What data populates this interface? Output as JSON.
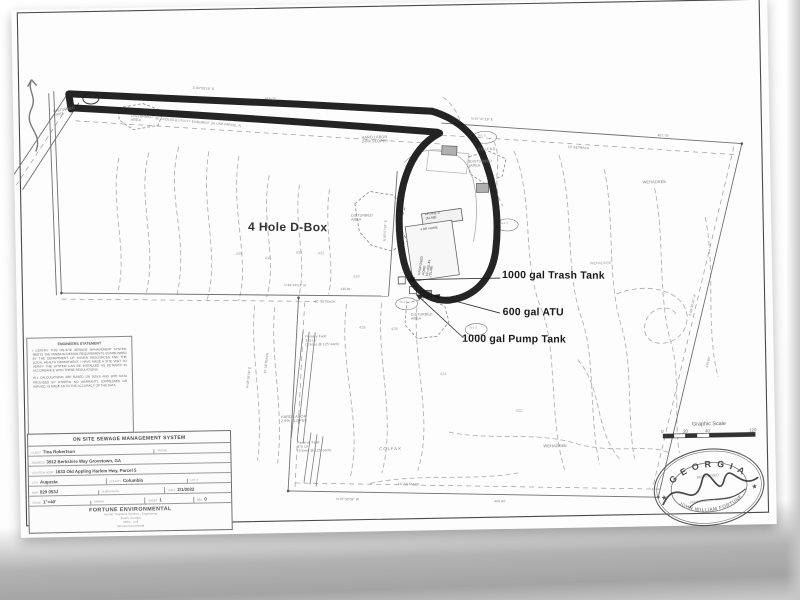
{
  "annotations": {
    "d_box": "4 Hole D-Box",
    "trash_tank": "1000 gal Trash Tank",
    "atu": "600 gal ATU",
    "pump_tank": "1000 gal Pump Tank"
  },
  "engineer_statement": {
    "title": "ENGINEERS STATEMENT",
    "para1": "I CERTIFY THIS ON-SITE SEWAGE MANAGEMENT SYSTEM MEETS THE MINIMUM DESIGN REQUIREMENTS ESTABLISHED BY THE DEPARTMENT OF HUMAN RESOURCES AND THE LOCAL HEALTH DEPARTMENT. I HAVE MADE A SITE VISIT TO VERIFY THE SYSTEM CAN BE INSTALLED AS DETAILED IN ACCORDANCE WITH THESE REGULATIONS.",
    "para2": "ALL CALCULATIONS ARE BASED ON SOILS AND SITE DATA PROVIDED BY OTHERS. NO WARRANTY, EXPRESSED OR IMPLIED, IS MADE AS TO THE ACCURACY OF THE DATA."
  },
  "title_block": {
    "header": "ON SITE SEWAGE MANAGEMENT SYSTEM",
    "client_label": "CLIENT",
    "client": "Tina Robertson",
    "phone_label": "PHONE",
    "address_label": "ADDRESS",
    "address": "3912 Berkshire Way Grovetown, GA",
    "location_label": "LOCATION ADDR",
    "location": "1633 Old Appling Harlem Hwy, Parcel 5",
    "city_label": "CITY",
    "city": "Augusta",
    "county_label": "COUNTY",
    "county": "Columbia",
    "lot_label": "LOT #",
    "map_label": "MAP",
    "map": "029 053J",
    "subdivision_label": "SUBDIVISION",
    "date_label": "DATE",
    "date": "2/1/2022",
    "scale_label": "SCALE",
    "scale": "1\"=40'",
    "drawn_label": "DRAWN",
    "sheet_label": "SHEET",
    "sheet": "1",
    "rev_label": "REV",
    "rev": "0",
    "company": "FORTUNE ENVIRONMENTAL",
    "company_lines": [
      "Aerobic Treatment Systems - Engineering",
      "Evans, Georgia",
      "Office - Cell",
      "fortuneenvironmental"
    ]
  },
  "scale_bar": {
    "title": "Graphic Scale",
    "ticks": [
      "0",
      "20",
      "40",
      "120"
    ]
  },
  "seal": {
    "state": "G E O R G I A",
    "name": "JOHN WILLIAM FORTUNE",
    "inner_top": "REGISTERED",
    "inner_mid": "PROFESSIONAL ENGINEER",
    "star": "★"
  },
  "map_labels": [
    {
      "t": "DISTURBED\nAREA",
      "x": 40,
      "y": 100,
      "s": 3.6,
      "r": -8
    },
    {
      "t": "DISTURBED\nAREA",
      "x": 118,
      "y": 106,
      "s": 3.6,
      "r": 4
    },
    {
      "t": "DISTURBED\nAREA",
      "x": 336,
      "y": 210,
      "s": 3.6
    },
    {
      "t": "DISTURBED\nAREA",
      "x": 456,
      "y": 158,
      "s": 3.6
    },
    {
      "t": "DISTURBED\nAREA",
      "x": 394,
      "y": 310,
      "s": 3.6
    },
    {
      "t": "HARD LABOR\n2-6% SLOPES",
      "x": 348,
      "y": 132,
      "s": 3.8
    },
    {
      "t": "HARD LABOR\n2-6% SLOPES",
      "x": 262,
      "y": 410,
      "s": 3.8
    },
    {
      "t": "COLFAX",
      "x": 360,
      "y": 444,
      "s": 4.2,
      "ls": 1
    },
    {
      "t": "COLFAX",
      "x": 464,
      "y": 146,
      "s": 3.8,
      "ls": 0.5
    },
    {
      "t": "WEHADKEE",
      "x": 524,
      "y": 444,
      "s": 4
    },
    {
      "t": "WEHADKEE",
      "x": 628,
      "y": 182,
      "s": 4
    },
    {
      "t": "WEHADKEE",
      "x": 574,
      "y": 262,
      "s": 3.6,
      "c": "light"
    },
    {
      "t": "Primary Field\n375 LF\n(3 lines @ 125' each)",
      "x": 288,
      "y": 330,
      "s": 3.4
    },
    {
      "t": "Reserve Field\n375 LF\n(3 lines @ 125' each)",
      "x": 278,
      "y": 436,
      "s": 3.4
    },
    {
      "t": "438",
      "x": 220,
      "y": 246,
      "s": 3.8,
      "c": "light"
    },
    {
      "t": "436",
      "x": 249,
      "y": 251,
      "s": 3.8,
      "c": "light"
    },
    {
      "t": "434",
      "x": 280,
      "y": 246,
      "s": 3.8,
      "c": "light"
    },
    {
      "t": "432",
      "x": 302,
      "y": 247,
      "s": 3.8,
      "c": "light"
    },
    {
      "t": "430",
      "x": 337,
      "y": 271,
      "s": 3.8,
      "c": "light"
    },
    {
      "t": "428",
      "x": 342,
      "y": 322,
      "s": 3.8,
      "c": "light"
    },
    {
      "t": "426",
      "x": 374,
      "y": 324,
      "s": 3.8,
      "c": "light"
    },
    {
      "t": "424",
      "x": 422,
      "y": 370,
      "s": 3.8,
      "c": "light"
    },
    {
      "t": "422",
      "x": 497,
      "y": 408,
      "s": 3.8,
      "c": "light"
    },
    {
      "t": "S 84°09'19\" E",
      "x": 180,
      "y": 80,
      "s": 3.3,
      "r": 5
    },
    {
      "t": "425.02'",
      "x": 252,
      "y": 92,
      "s": 3.3,
      "r": 5
    },
    {
      "t": "30' ACCESS & UTILITY EASEMENT (IN USE PARCEL 4)",
      "x": 142,
      "y": 110,
      "s": 3.2,
      "r": 6
    },
    {
      "t": "N 87°47'19\" E",
      "x": 458,
      "y": 116,
      "s": 3.3,
      "r": 4
    },
    {
      "t": "487.76'",
      "x": 644,
      "y": 136,
      "s": 3.3,
      "r": 5
    },
    {
      "t": "10' SETBACK",
      "x": 554,
      "y": 146,
      "s": 3.3,
      "r": 5
    },
    {
      "t": "N 87°59'09\" W",
      "x": 316,
      "y": 494,
      "s": 3.3,
      "r": 2
    },
    {
      "t": "10' SETBACK",
      "x": 378,
      "y": 480,
      "s": 3.3,
      "r": 2
    },
    {
      "t": "485.94'",
      "x": 474,
      "y": 499,
      "s": 3.3,
      "r": 2
    },
    {
      "t": "N 84°49'51\" W",
      "x": 268,
      "y": 279,
      "s": 3.2,
      "r": 2
    },
    {
      "t": "139.81'",
      "x": 324,
      "y": 284,
      "s": 3.2,
      "r": 2
    },
    {
      "t": "10' SETBACK",
      "x": 298,
      "y": 296,
      "s": 3.2,
      "r": 2
    },
    {
      "t": "N 05°57'39\" E",
      "x": 368,
      "y": 238,
      "s": 3.2,
      "r": -86
    },
    {
      "t": "10' SETBACK",
      "x": 246,
      "y": 368,
      "s": 3.2,
      "r": -82
    },
    {
      "t": "N 08°06'46\" E",
      "x": 228,
      "y": 382,
      "s": 3.2,
      "r": -82
    },
    {
      "t": "S 09°36'16\" W",
      "x": 672,
      "y": 318,
      "s": 3.2,
      "r": -76
    },
    {
      "t": "370.60'",
      "x": 688,
      "y": 370,
      "s": 3.2,
      "r": -76
    },
    {
      "t": "3e1-5",
      "x": 464,
      "y": 133,
      "s": 3,
      "c": "light"
    },
    {
      "t": "3e1-5",
      "x": 485,
      "y": 221,
      "s": 3,
      "c": "light"
    },
    {
      "t": "3e1-5",
      "x": 383,
      "y": 298,
      "s": 3,
      "c": "light"
    },
    {
      "t": "3e1-5",
      "x": 452,
      "y": 325,
      "s": 3,
      "c": "light"
    },
    {
      "t": "FF=431.3\n(SLAB)",
      "x": 410,
      "y": 211,
      "s": 3.2,
      "r": -6,
      "c": "dark"
    },
    {
      "t": "4 BR HOME",
      "x": 405,
      "y": 226,
      "s": 3,
      "r": -6,
      "c": "dark"
    },
    {
      "t": "PROPOSED\nHOME\nFF=431.45\n(SLAB)",
      "x": 402,
      "y": 272,
      "s": 3.2,
      "r": -80,
      "c": "dark"
    }
  ]
}
